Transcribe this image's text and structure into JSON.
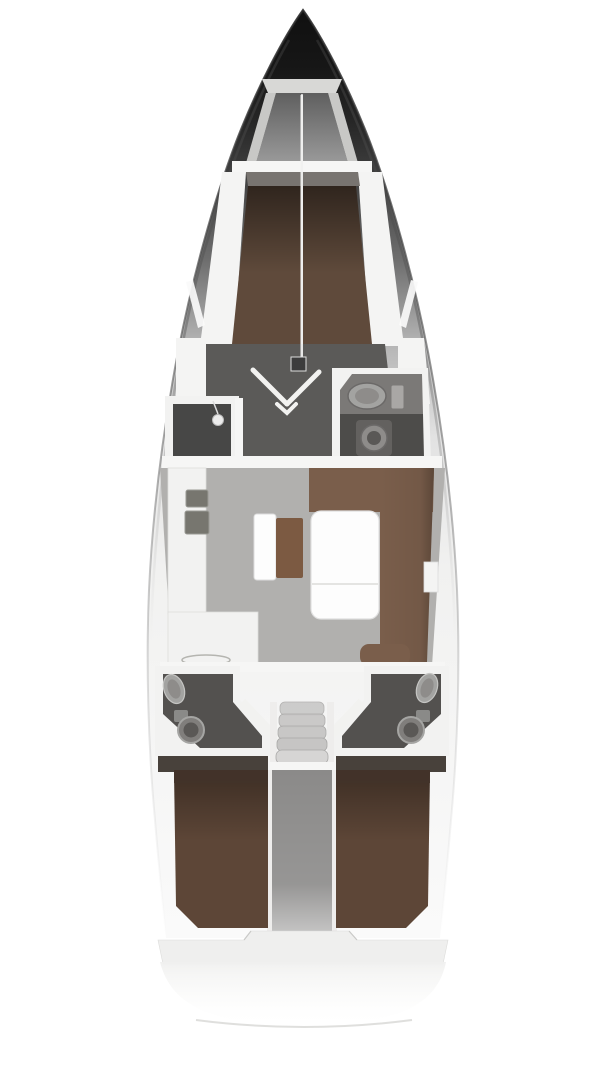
{
  "page": {
    "background": "#ffffff",
    "width": 608,
    "height": 1080
  },
  "diagram": {
    "type": "yacht-interior-floorplan",
    "subject": "sailing-yacht-layout-plan",
    "view": "top-down",
    "orientation": "bow-up"
  },
  "colors": {
    "page_bg": "#ffffff",
    "deck_white": "#f4f4f3",
    "bulkhead_white": "#f6f6f5",
    "hatch_gray": "#d8d8d6",
    "rail_gray": "#cfcfcd",
    "locker_wall": "#c8c8c6",
    "floor_forward": "#5b5a58",
    "floor_salon": "#b1b0ae",
    "shower_floor": "#474746",
    "head_floor": "#4d4c4a",
    "counter_top_gray": "#7b7977",
    "vberth_brown": "#5f4a3b",
    "bed_brown": "#5d4637",
    "headboard_brown": "#42332a",
    "settee_brown": "#7a5e4b",
    "bench_brown": "#7c5a42",
    "table_white": "#fdfdfd",
    "counter_white": "#f2f2f1",
    "sink_dark": "#77766f",
    "fixture_light": "#a3a3a1",
    "fixture_mid": "#8e8c8a",
    "fixture_dark": "#5a5856",
    "steps_gray": "#c6c5c4",
    "step_rail_white": "#eeedec",
    "engine_gray": "#8b8a89",
    "cabin_floor_shadow": "#48413b",
    "stern_white": "#efefee",
    "transom_line": "#d4d4d2",
    "mast_white": "#f0f0ef",
    "window_white": "#fafafa",
    "gray_strip": "#787470",
    "mast_step_dark": "#3c3c3c"
  },
  "areas": [
    {
      "id": "anchor-locker",
      "position": "bow",
      "fixtures": [
        "hatch",
        "locker-rails",
        "locker-floor"
      ]
    },
    {
      "id": "forward-cabin",
      "position": "fore",
      "fixtures": [
        "v-berth-double-bed",
        "wardrobe-doors",
        "mast-step"
      ]
    },
    {
      "id": "shower-compartment",
      "position": "midship-port",
      "fixtures": [
        "shower-head"
      ]
    },
    {
      "id": "forward-head",
      "position": "midship-starboard",
      "fixtures": [
        "sink",
        "faucet",
        "toilet"
      ]
    },
    {
      "id": "galley",
      "position": "salon-port",
      "fixtures": [
        "double-sink",
        "l-counter",
        "stove-oval"
      ]
    },
    {
      "id": "salon",
      "position": "midship",
      "fixtures": [
        "folding-table",
        "u-settee",
        "bench-seat",
        "seat-cushion"
      ]
    },
    {
      "id": "aft-head-port",
      "position": "aft-port",
      "fixtures": [
        "sink",
        "toilet"
      ]
    },
    {
      "id": "aft-head-starboard",
      "position": "aft-starboard",
      "fixtures": [
        "sink",
        "toilet"
      ]
    },
    {
      "id": "companionway",
      "position": "aft-center",
      "fixtures": [
        "steps"
      ]
    },
    {
      "id": "engine-compartment",
      "position": "aft-center",
      "fixtures": []
    },
    {
      "id": "aft-cabin-port",
      "position": "stern-port",
      "fixtures": [
        "double-bed"
      ]
    },
    {
      "id": "aft-cabin-starboard",
      "position": "stern-starboard",
      "fixtures": [
        "double-bed"
      ]
    },
    {
      "id": "stern-platform",
      "position": "stern",
      "fixtures": [
        "transom-curve"
      ]
    }
  ]
}
